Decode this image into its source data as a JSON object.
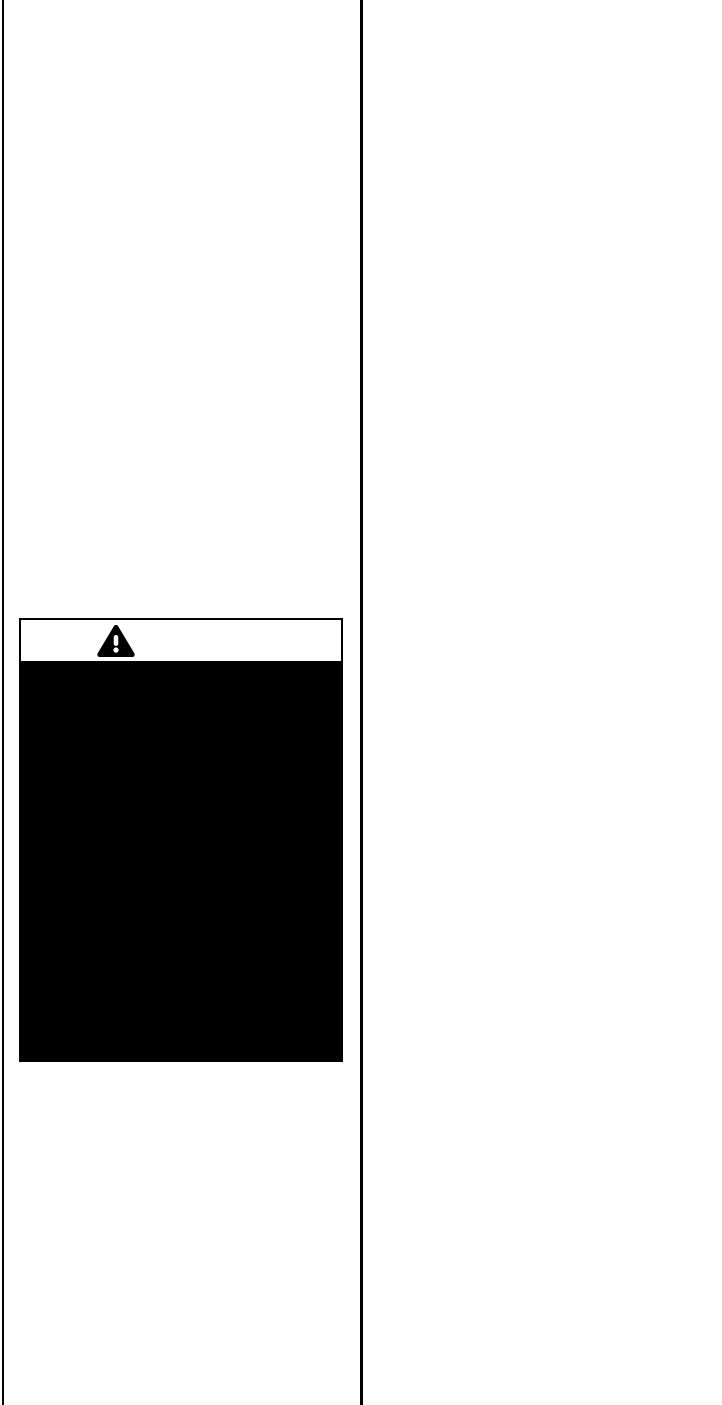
{
  "document": {
    "background_color": "#ffffff",
    "ink_color": "#000000"
  },
  "layout": {
    "type": "two-column scanned page",
    "left_column_text": "",
    "right_column_text": ""
  },
  "warning_figure": {
    "icon": "warning-triangle-icon",
    "icon_glyph": "⚠",
    "triangle_fill": "#000000",
    "exclamation_fill": "#ffffff",
    "header_background": "#ffffff",
    "body_background": "#000000",
    "caption_text": ""
  }
}
